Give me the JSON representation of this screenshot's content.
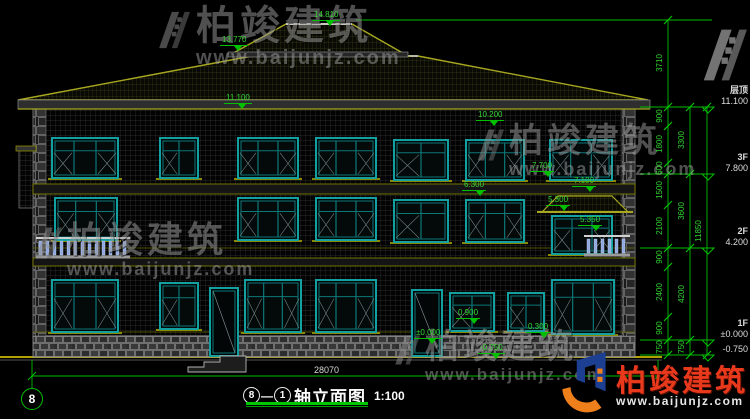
{
  "watermark": {
    "brand": "柏竣建筑",
    "url": "www.baijunjz.com"
  },
  "logo": {
    "brand": "柏竣建筑",
    "url": "www.baijunjz.com"
  },
  "title_block": {
    "axis_start": "8",
    "separator": "—",
    "axis_end": "1",
    "title": "轴立面图",
    "scale": "1:100"
  },
  "axis_bubble_left": "8",
  "bottom_dimension": "28070",
  "levels": [
    {
      "name": "层顶",
      "elev": "11.100",
      "y": 107
    },
    {
      "name": "3F",
      "elev": "7.800",
      "y": 174
    },
    {
      "name": "2F",
      "elev": "4.200",
      "y": 248
    },
    {
      "name": "1F",
      "elev": "±0.000",
      "y": 340
    },
    {
      "name": "",
      "elev": "-0.750",
      "y": 355
    }
  ],
  "dims_inner": [
    {
      "v": "3710",
      "y": 63
    },
    {
      "v": "900",
      "y": 116
    },
    {
      "v": "1800",
      "y": 144
    },
    {
      "v": "600",
      "y": 168
    },
    {
      "v": "1500",
      "y": 190
    },
    {
      "v": "2100",
      "y": 226
    },
    {
      "v": "900",
      "y": 257
    },
    {
      "v": "2400",
      "y": 292
    },
    {
      "v": "900",
      "y": 328
    },
    {
      "v": "750",
      "y": 347
    }
  ],
  "dims_mid": [
    {
      "v": "3300",
      "y": 140
    },
    {
      "v": "3600",
      "y": 211
    },
    {
      "v": "4200",
      "y": 294
    },
    {
      "v": "750",
      "y": 347
    }
  ],
  "dims_total": {
    "v": "11850",
    "y": 231
  },
  "elevation_markers": [
    {
      "v": "14.810",
      "x": 312,
      "y": 11
    },
    {
      "v": "13.770",
      "x": 220,
      "y": 36
    },
    {
      "v": "11.100",
      "x": 224,
      "y": 94
    },
    {
      "v": "10.200",
      "x": 476,
      "y": 111
    },
    {
      "v": "7.700",
      "x": 530,
      "y": 162
    },
    {
      "v": "7.100",
      "x": 572,
      "y": 177
    },
    {
      "v": "6.300",
      "x": 462,
      "y": 181
    },
    {
      "v": "5.300",
      "x": 546,
      "y": 196
    },
    {
      "v": "5.350",
      "x": 578,
      "y": 216
    },
    {
      "v": "0.900",
      "x": 456,
      "y": 309
    },
    {
      "v": "±0.000",
      "x": 414,
      "y": 329
    },
    {
      "v": "0.300",
      "x": 526,
      "y": 323
    },
    {
      "v": "-0.750",
      "x": 478,
      "y": 344
    }
  ]
}
